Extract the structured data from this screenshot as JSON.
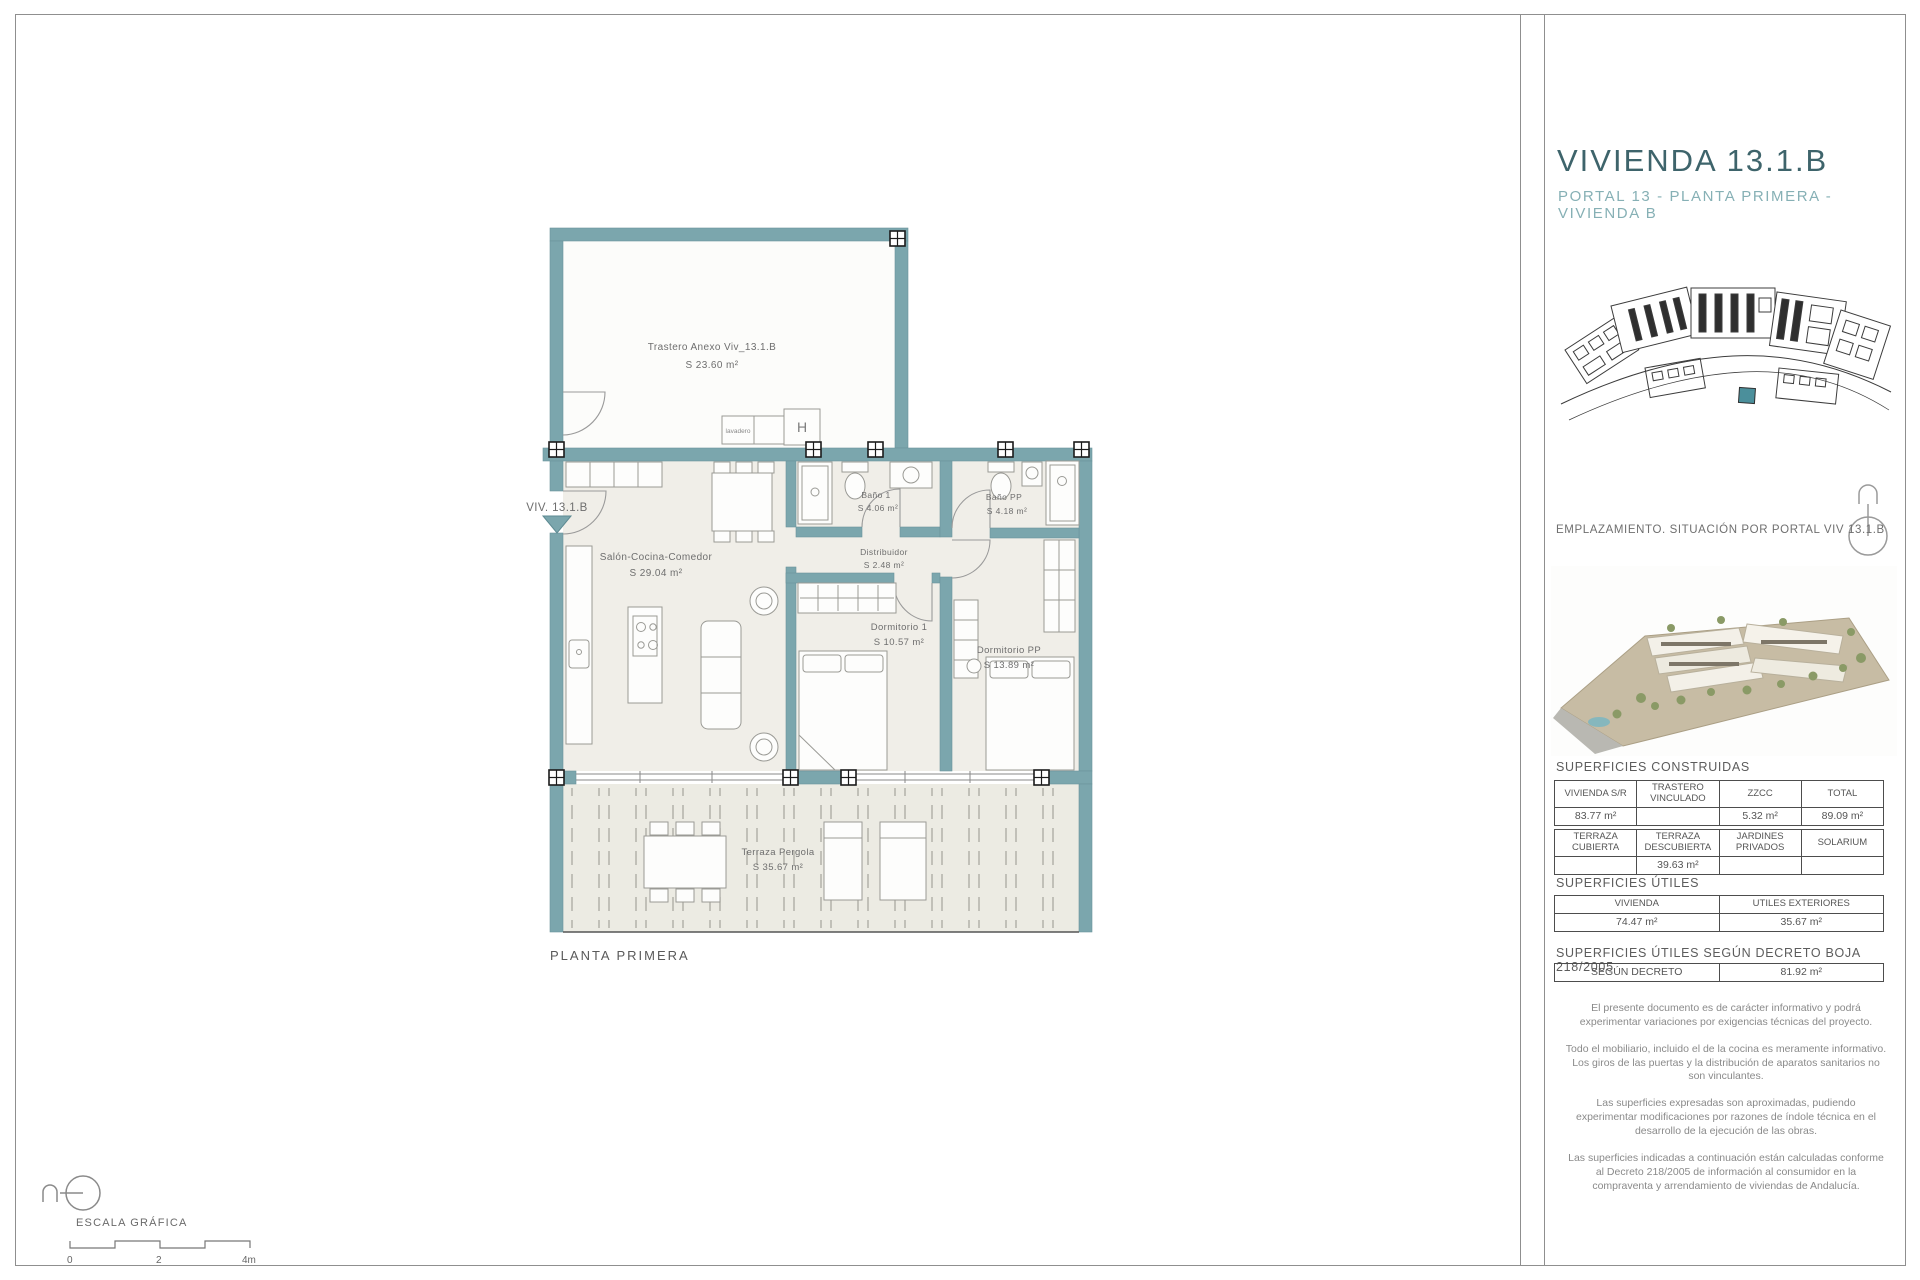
{
  "colors": {
    "wall": "#7ba6ad",
    "accent": "#3e646b",
    "subtitle": "#86b0b5",
    "highlight": "#4b8f9b"
  },
  "panel": {
    "title": "VIVIENDA 13.1.B",
    "subtitle": "PORTAL 13 - PLANTA PRIMERA - VIVIENDA B",
    "emplazamiento_caption": "EMPLAZAMIENTO. SITUACIÓN POR PORTAL VIV 13.1.B",
    "construidas_heading": "SUPERFICIES CONSTRUIDAS",
    "t1_headers": [
      "VIVIENDA S/R",
      "TRASTERO VINCULADO",
      "ZZCC",
      "TOTAL"
    ],
    "t1_values": [
      "83.77 m²",
      "",
      "5.32 m²",
      "89.09 m²"
    ],
    "t2_headers": [
      "TERRAZA CUBIERTA",
      "TERRAZA DESCUBIERTA",
      "JARDINES PRIVADOS",
      "SOLARIUM"
    ],
    "t2_values": [
      "",
      "39.63 m²",
      "",
      ""
    ],
    "utiles_heading": "SUPERFICIES ÚTILES",
    "t3_headers": [
      "VIVIENDA",
      "UTILES EXTERIORES"
    ],
    "t3_values": [
      "74.47 m²",
      "35.67 m²"
    ],
    "decreto_heading": "SUPERFICIES ÚTILES SEGÚN DECRETO BOJA 218/2005",
    "t4_label": "SEGÚN DECRETO",
    "t4_value": "81.92 m²",
    "disclaimers": [
      "El presente documento es de carácter informativo y podrá experimentar variaciones por exigencias técnicas del proyecto.",
      "Todo el mobiliario, incluido el de la cocina es meramente informativo. Los giros de las puertas y la distribución de aparatos sanitarios no son vinculantes.",
      "Las superficies expresadas son aproximadas, pudiendo experimentar modificaciones por razones de índole técnica en el desarrollo de la ejecución de las obras.",
      "Las superficies indicadas a continuación están calculadas conforme al Decreto 218/2005 de información al consumidor en la compraventa y arrendamiento de viviendas de Andalucía."
    ]
  },
  "floorplan": {
    "viv_label": "VIV. 13.1.B",
    "plan_caption": "PLANTA PRIMERA",
    "rooms": {
      "trastero": {
        "name": "Trastero Anexo Viv_13.1.B",
        "area": "S 23.60 m²"
      },
      "salon": {
        "name": "Salón-Cocina-Comedor",
        "area": "S 29.04 m²"
      },
      "bano1": {
        "name": "Baño 1",
        "area": "S 4.06 m²"
      },
      "banopp": {
        "name": "Baño PP",
        "area": "S 4.18 m²"
      },
      "distribuidor": {
        "name": "Distribuidor",
        "area": "S 2.48 m²"
      },
      "dorm1": {
        "name": "Dormitorio 1",
        "area": "S 10.57 m²"
      },
      "dormpp": {
        "name": "Dormitorio PP",
        "area": "S 13.89 m²"
      },
      "terraza": {
        "name": "Terraza Pergola",
        "area": "S 35.67 m²"
      }
    },
    "lavadero_label": "lavadero",
    "washer_label": "H"
  },
  "scale": {
    "caption": "ESCALA GRÁFICA",
    "tick0": "0",
    "tick1": "2",
    "tick2": "4m"
  }
}
